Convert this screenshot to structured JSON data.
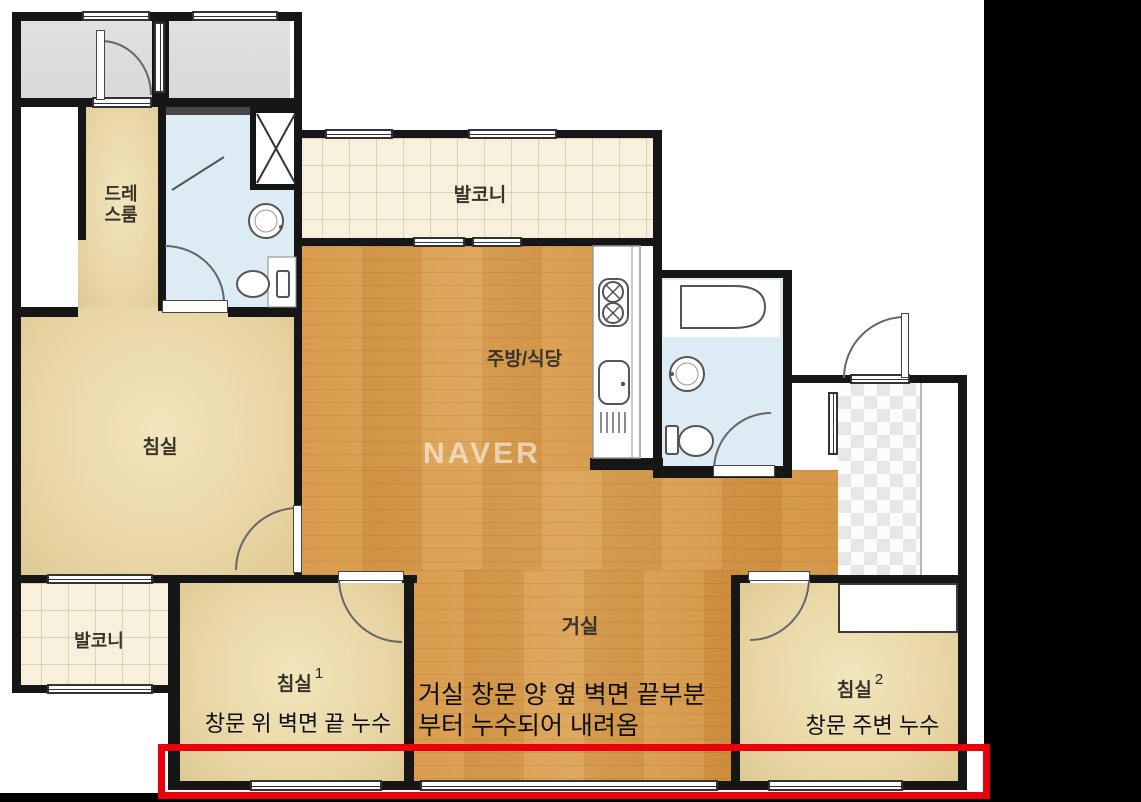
{
  "plan": {
    "watermark": "NAVER",
    "rooms": {
      "dress_line1": "드레",
      "dress_line2": "스룸",
      "balcony_top": "발코니",
      "kitchen": "주방/식당",
      "bedroom_left": "침실",
      "balcony_bottom": "발코니",
      "living": "거실",
      "bedroom1": "침실",
      "bedroom1_num": "1",
      "bedroom2": "침실",
      "bedroom2_num": "2"
    },
    "annotations": {
      "bedroom1_leak": "창문 위 벽면 끝 누수",
      "living_leak_line1": "거실 창문 양 옆 벽면 끝부분",
      "living_leak_line2": "부터 누수되어 내려옴",
      "bedroom2_leak": "창문 주변 누수"
    },
    "colors": {
      "highlight_red": "#e8000a",
      "wall_black": "#161616",
      "wood_floor": "#d89b4c",
      "room_beige": "#e8d6a5",
      "balcony_cream": "#f8f0dc",
      "bathroom_blue": "#dcebf4",
      "gray_room": "#dedede"
    }
  }
}
